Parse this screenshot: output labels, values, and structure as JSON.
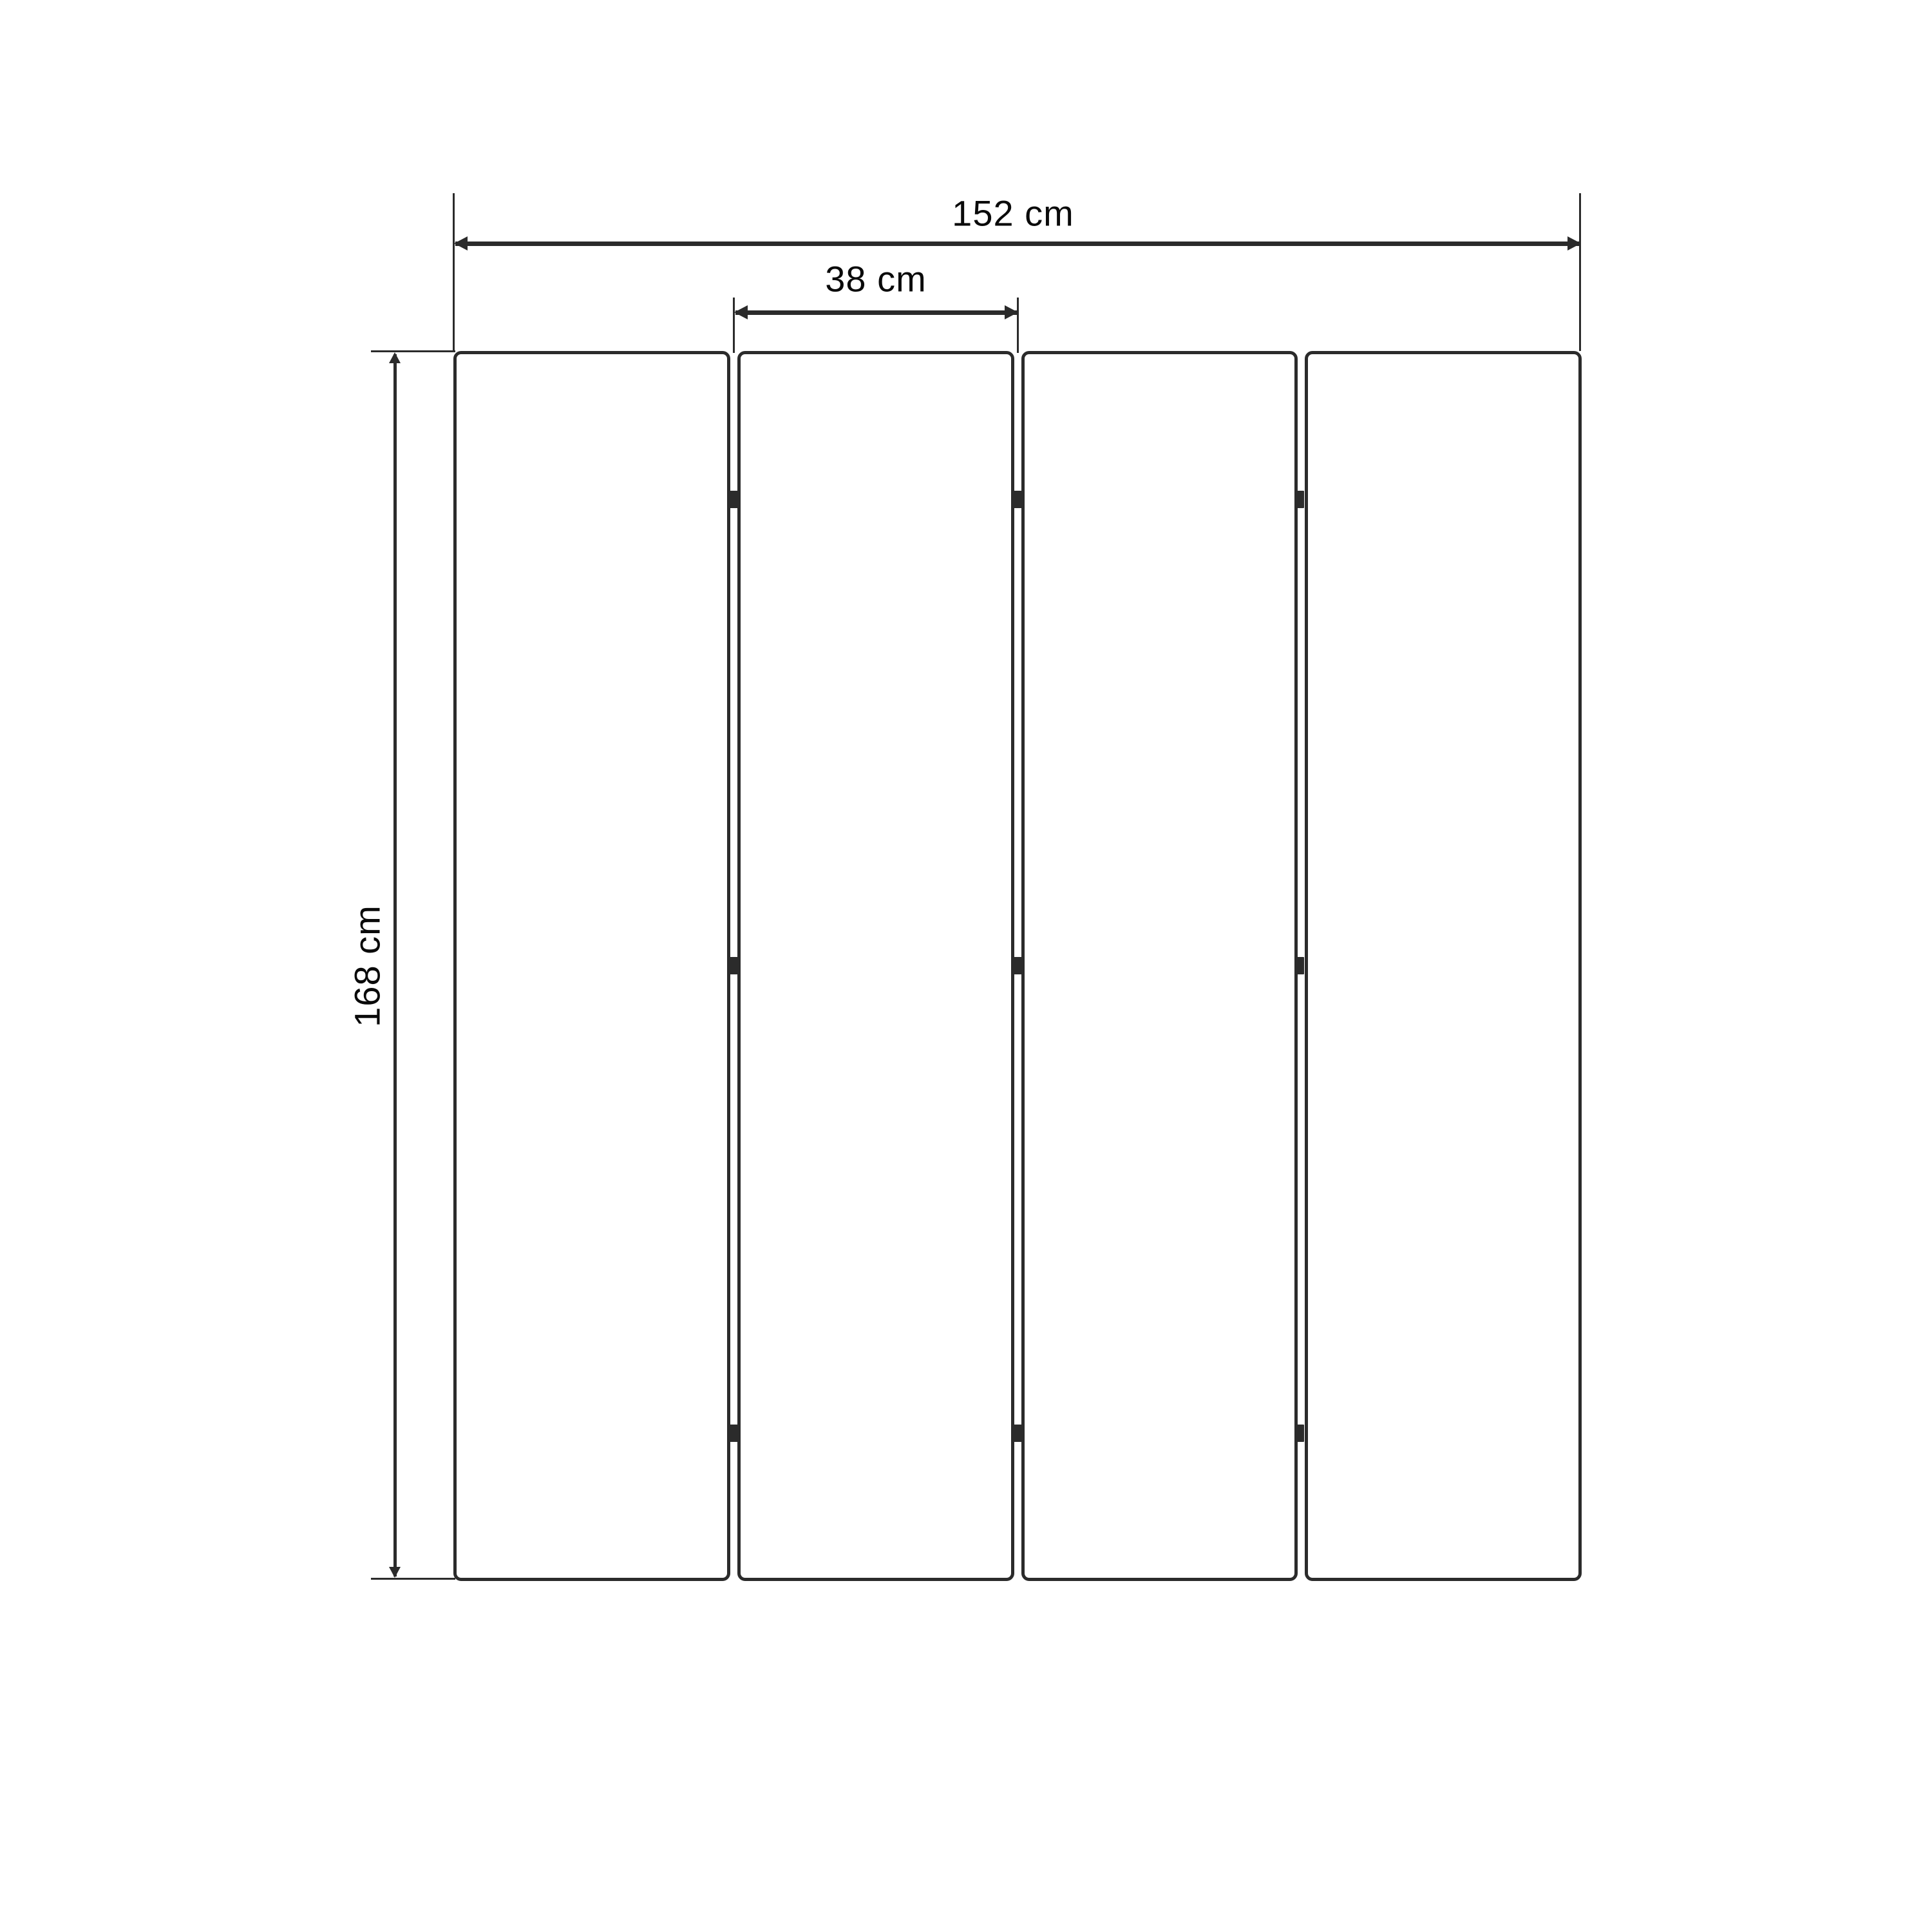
{
  "diagram": {
    "type": "dimensioned-technical-drawing",
    "subject": "four-panel folding screen, front elevation",
    "labels": {
      "total_width": "152 cm",
      "panel_width": "38 cm",
      "height": "168 cm"
    },
    "dimensions": {
      "total_width_cm": 152,
      "panel_width_cm": 38,
      "height_cm": 168
    },
    "structure": {
      "panel_count": 4,
      "gap_count": 3,
      "hinges_per_gap": 3
    }
  },
  "colors": {
    "line": "#2b2b2b",
    "text": "#0a0a0a",
    "background": "#ffffff",
    "panel_fill": "#ffffff"
  }
}
